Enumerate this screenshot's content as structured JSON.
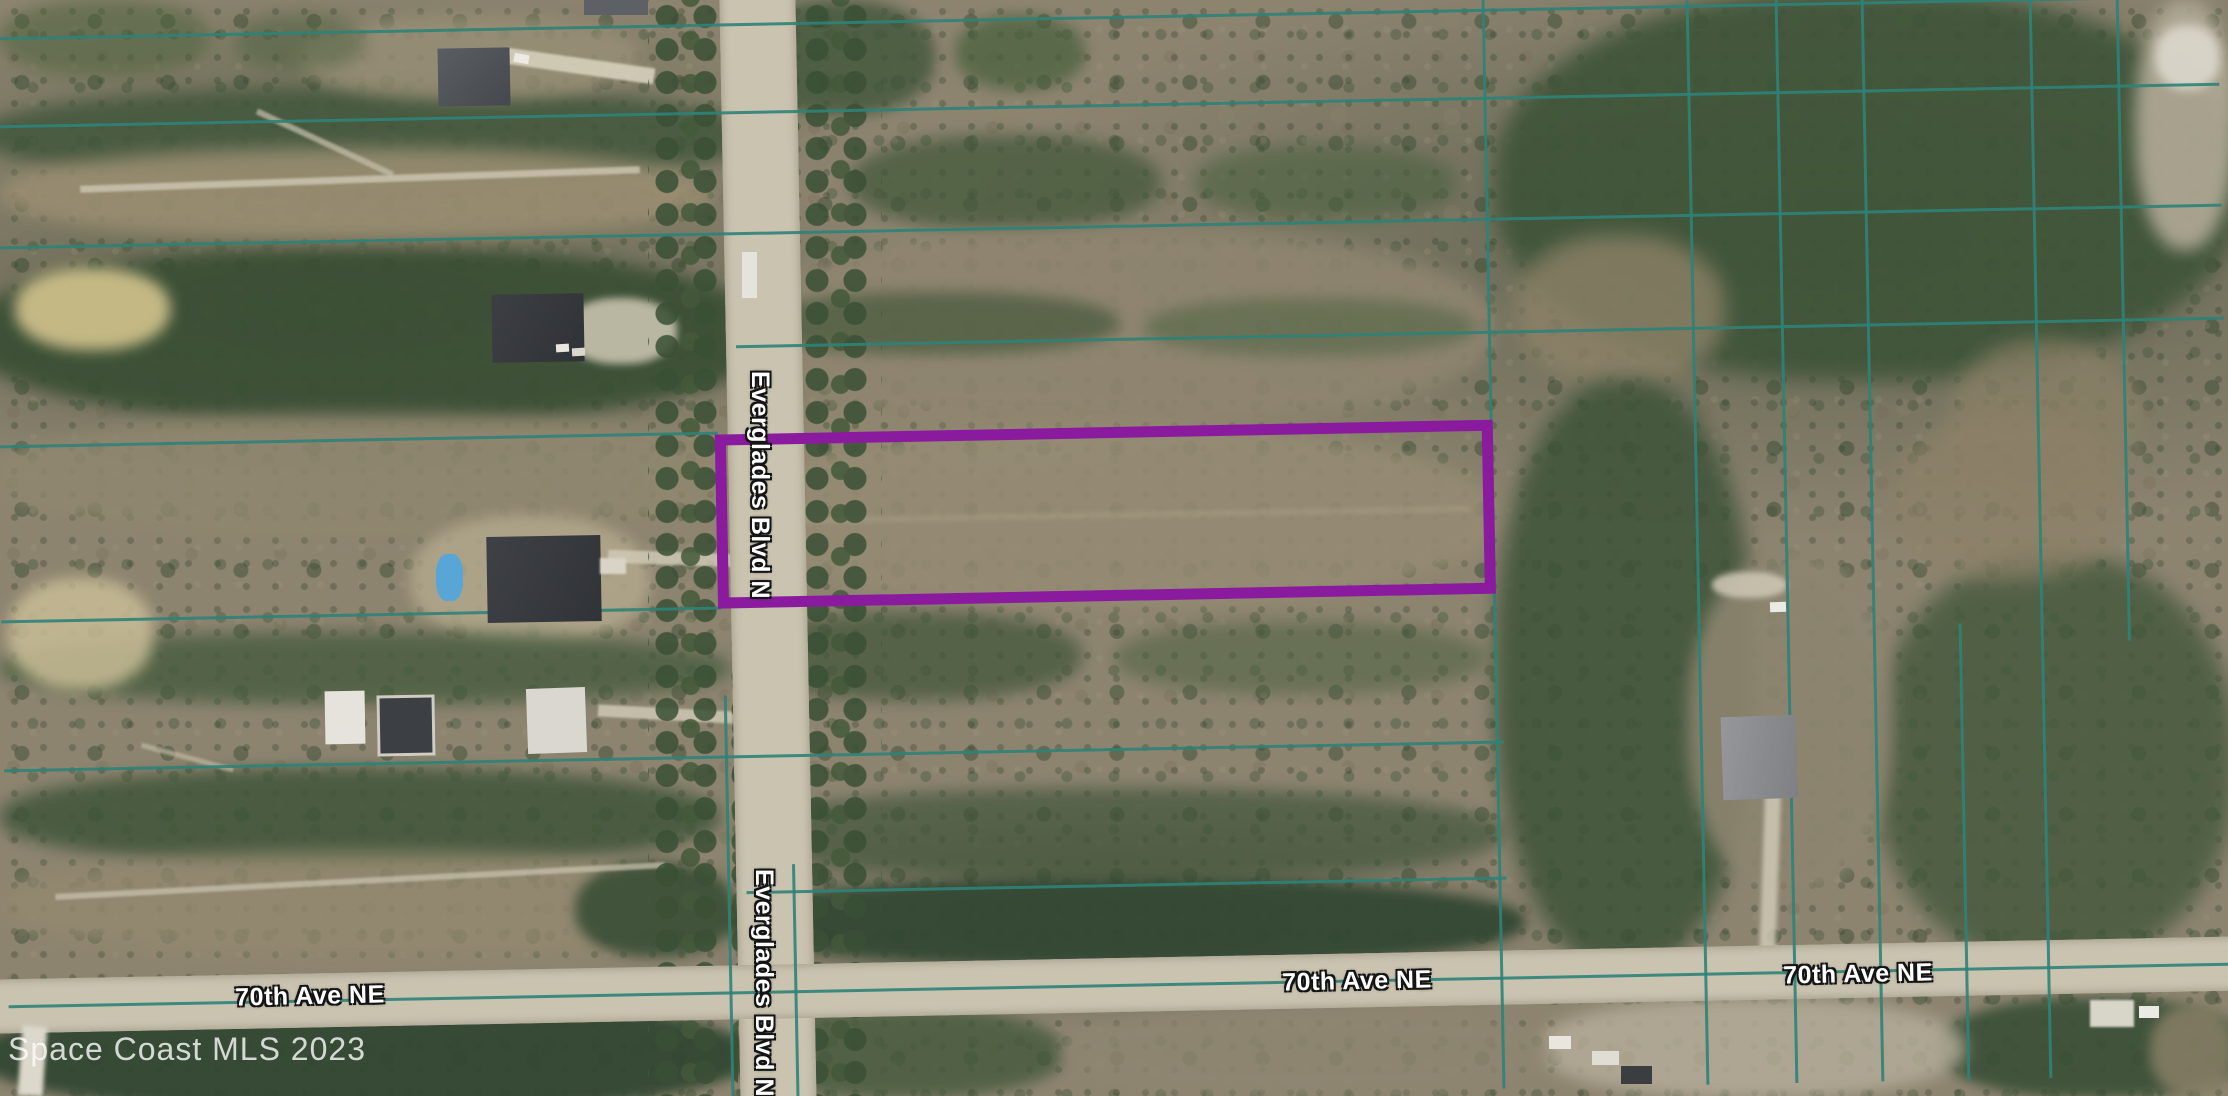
{
  "map": {
    "watermark": "Space Coast MLS 2023",
    "roads": {
      "vertical_road": {
        "name": "Everglades Blvd N",
        "label_top": "Everglades Blvd N",
        "label_bottom": "Everglades Blvd N"
      },
      "horizontal_road": {
        "name": "70th Ave NE",
        "label_left": "70th Ave NE",
        "label_center": "70th Ave NE",
        "label_right": "70th Ave NE"
      }
    },
    "overlay": {
      "highlighted_parcel_outline_color": "#8a1b9e",
      "parcel_grid_line_color": "#2f8278"
    }
  }
}
